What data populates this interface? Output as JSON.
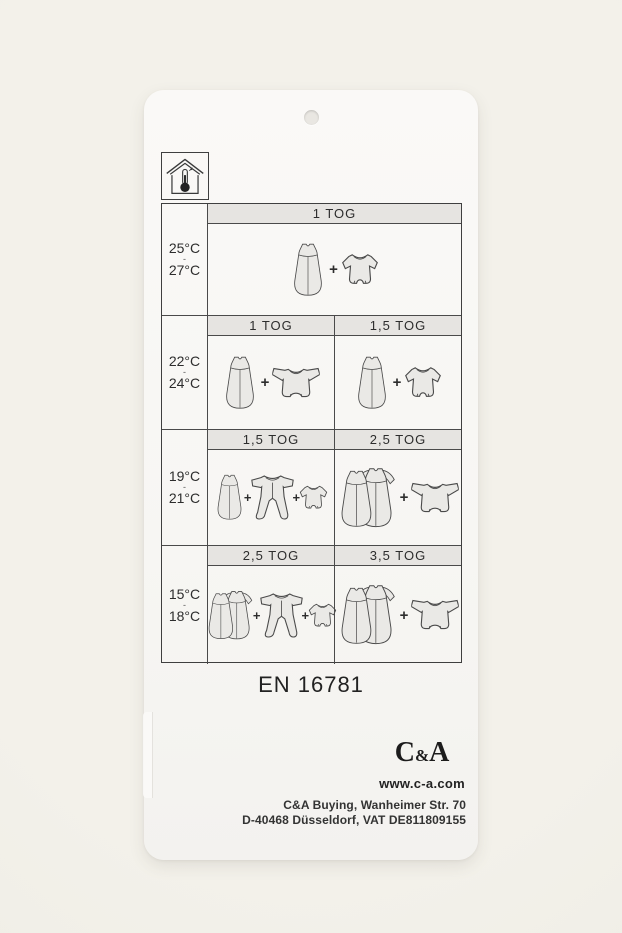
{
  "tag": {
    "standard_label": "EN 16781",
    "brand": {
      "c": "C",
      "amp": "&",
      "a": "A"
    },
    "website": "www.c-a.com",
    "address": {
      "line1": "C&A Buying, Wanheimer Str. 70",
      "line2": "D-40468 Düsseldorf, VAT DE811809155"
    },
    "icons": {
      "top_left": "house-room-temperature-icon",
      "hole": "punch-hole"
    }
  },
  "table": {
    "plus": "+",
    "rows": [
      {
        "temp": {
          "from": "25°C",
          "dash": "-",
          "to": "27°C"
        },
        "cells": [
          {
            "tog": "1 TOG",
            "items": [
              "sleeping-bag",
              "plus",
              "bodysuit-short"
            ]
          }
        ]
      },
      {
        "temp": {
          "from": "22°C",
          "dash": "-",
          "to": "24°C"
        },
        "cells": [
          {
            "tog": "1 TOG",
            "items": [
              "sleeping-bag",
              "plus",
              "bodysuit-long"
            ]
          },
          {
            "tog": "1,5 TOG",
            "items": [
              "sleeping-bag",
              "plus",
              "bodysuit-short"
            ]
          }
        ]
      },
      {
        "temp": {
          "from": "19°C",
          "dash": "-",
          "to": "21°C"
        },
        "cells": [
          {
            "tog": "1,5 TOG",
            "items": [
              "sleeping-bag",
              "plus",
              "sleepsuit",
              "plus",
              "bodysuit-short"
            ]
          },
          {
            "tog": "2,5 TOG",
            "items": [
              "sleeping-bag-sleeved",
              "plus",
              "bodysuit-long"
            ]
          }
        ]
      },
      {
        "temp": {
          "from": "15°C",
          "dash": "-",
          "to": "18°C"
        },
        "cells": [
          {
            "tog": "2,5 TOG",
            "items": [
              "sleeping-bag-sleeved",
              "plus",
              "sleepsuit",
              "plus",
              "bodysuit-short"
            ]
          },
          {
            "tog": "3,5 TOG",
            "items": [
              "sleeping-bag-sleeved",
              "plus",
              "bodysuit-long"
            ]
          }
        ]
      }
    ]
  },
  "colors": {
    "page_background": "#f1efe8",
    "tag_background": "#f8f7f5",
    "table_line": "#3f3f3f",
    "header_band": "#e6e4e1",
    "garment_fill": "#eae9e6",
    "text": "#2d2d2d"
  }
}
